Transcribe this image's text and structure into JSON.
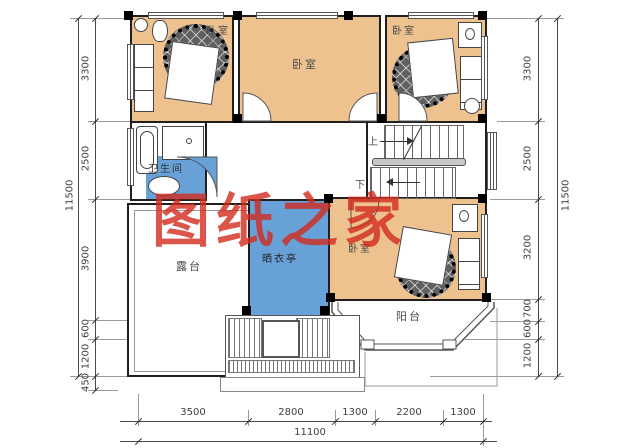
{
  "watermark": {
    "text": "图纸之家",
    "color": "rgba(210,42,30,0.8)"
  },
  "rooms": {
    "bedroom_top_left": {
      "label": "卧室"
    },
    "bedroom_top_center": {
      "label": "卧室"
    },
    "bedroom_top_right": {
      "label": "卧室"
    },
    "bedroom_bottom_right": {
      "label": "卧室"
    },
    "bathroom": {
      "label": "卫生间"
    },
    "terrace": {
      "label": "露台"
    },
    "drying_pavilion": {
      "label": "晒衣亭"
    },
    "balcony": {
      "label": "阳台"
    }
  },
  "stairs": {
    "up_label": "上",
    "down_label": "下"
  },
  "dimensions": {
    "left": [
      "3300",
      "2500",
      "3900",
      "600",
      "1200"
    ],
    "left_offset": "450",
    "left_total": "11500",
    "right": [
      "3300",
      "2500",
      "3200",
      "700",
      "600",
      "1200"
    ],
    "right_total": "11500",
    "bottom": [
      "3500",
      "2800",
      "1300",
      "2200",
      "1300"
    ],
    "bottom_total": "11100"
  },
  "colors": {
    "room_fill": "#eec28f",
    "wet_fill": "#68a1d8",
    "wall": "#1f1f1f",
    "dim_text": "#3f3f3f"
  }
}
